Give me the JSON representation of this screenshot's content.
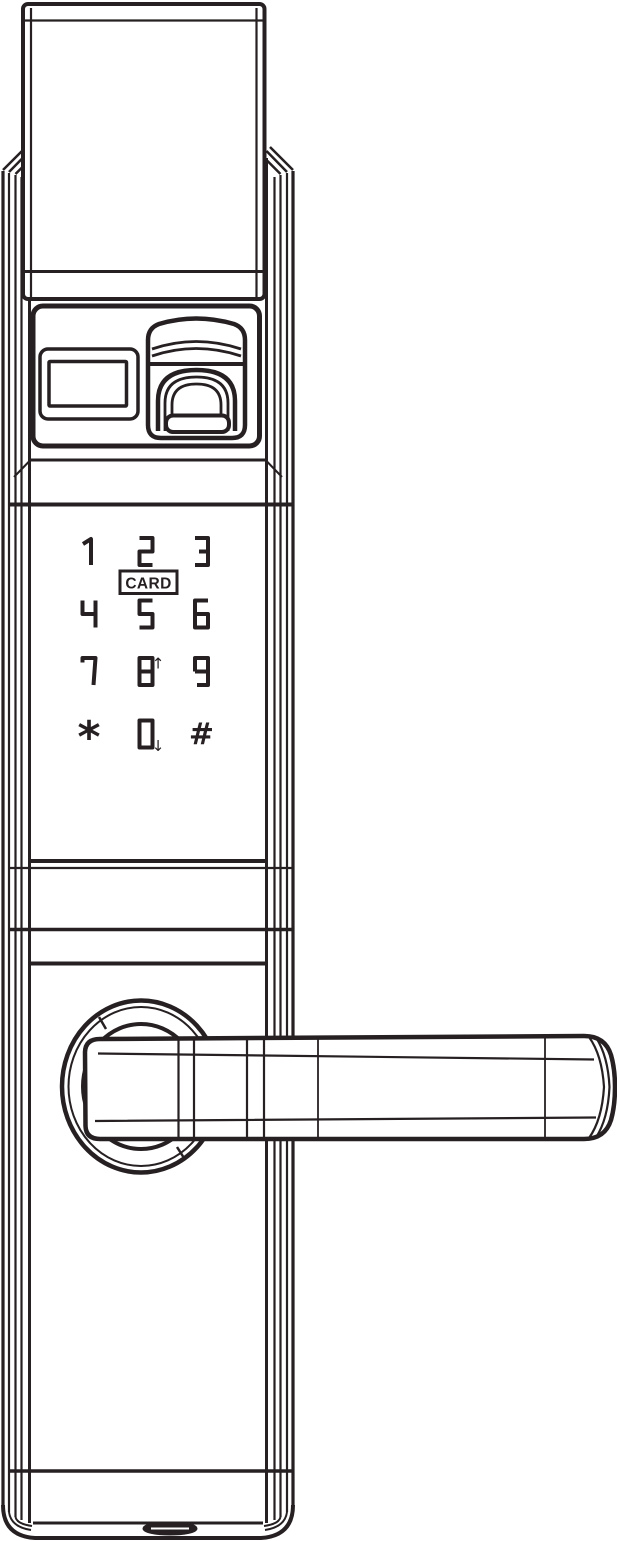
{
  "colors": {
    "line": "#262022",
    "background": "#ffffff"
  },
  "drawing": {
    "subject": "smart-door-lock-front-view",
    "components": [
      "top-block",
      "lock-body",
      "info-panel",
      "display-window",
      "fingerprint-scanner",
      "keypad",
      "card-reader-key",
      "door-handle",
      "handle-rosette",
      "bottom-port"
    ]
  },
  "keypad": {
    "card_label": "CARD",
    "keys": [
      {
        "id": "1",
        "label": "1"
      },
      {
        "id": "2",
        "label": "2"
      },
      {
        "id": "3",
        "label": "3"
      },
      {
        "id": "4",
        "label": "4"
      },
      {
        "id": "5",
        "label": "5"
      },
      {
        "id": "6",
        "label": "6"
      },
      {
        "id": "7",
        "label": "7"
      },
      {
        "id": "8",
        "label": "8",
        "arrow": "↑"
      },
      {
        "id": "9",
        "label": "9"
      },
      {
        "id": "star",
        "label": "*"
      },
      {
        "id": "0",
        "label": "0",
        "arrow": "↓"
      },
      {
        "id": "hash",
        "label": "#"
      }
    ]
  }
}
